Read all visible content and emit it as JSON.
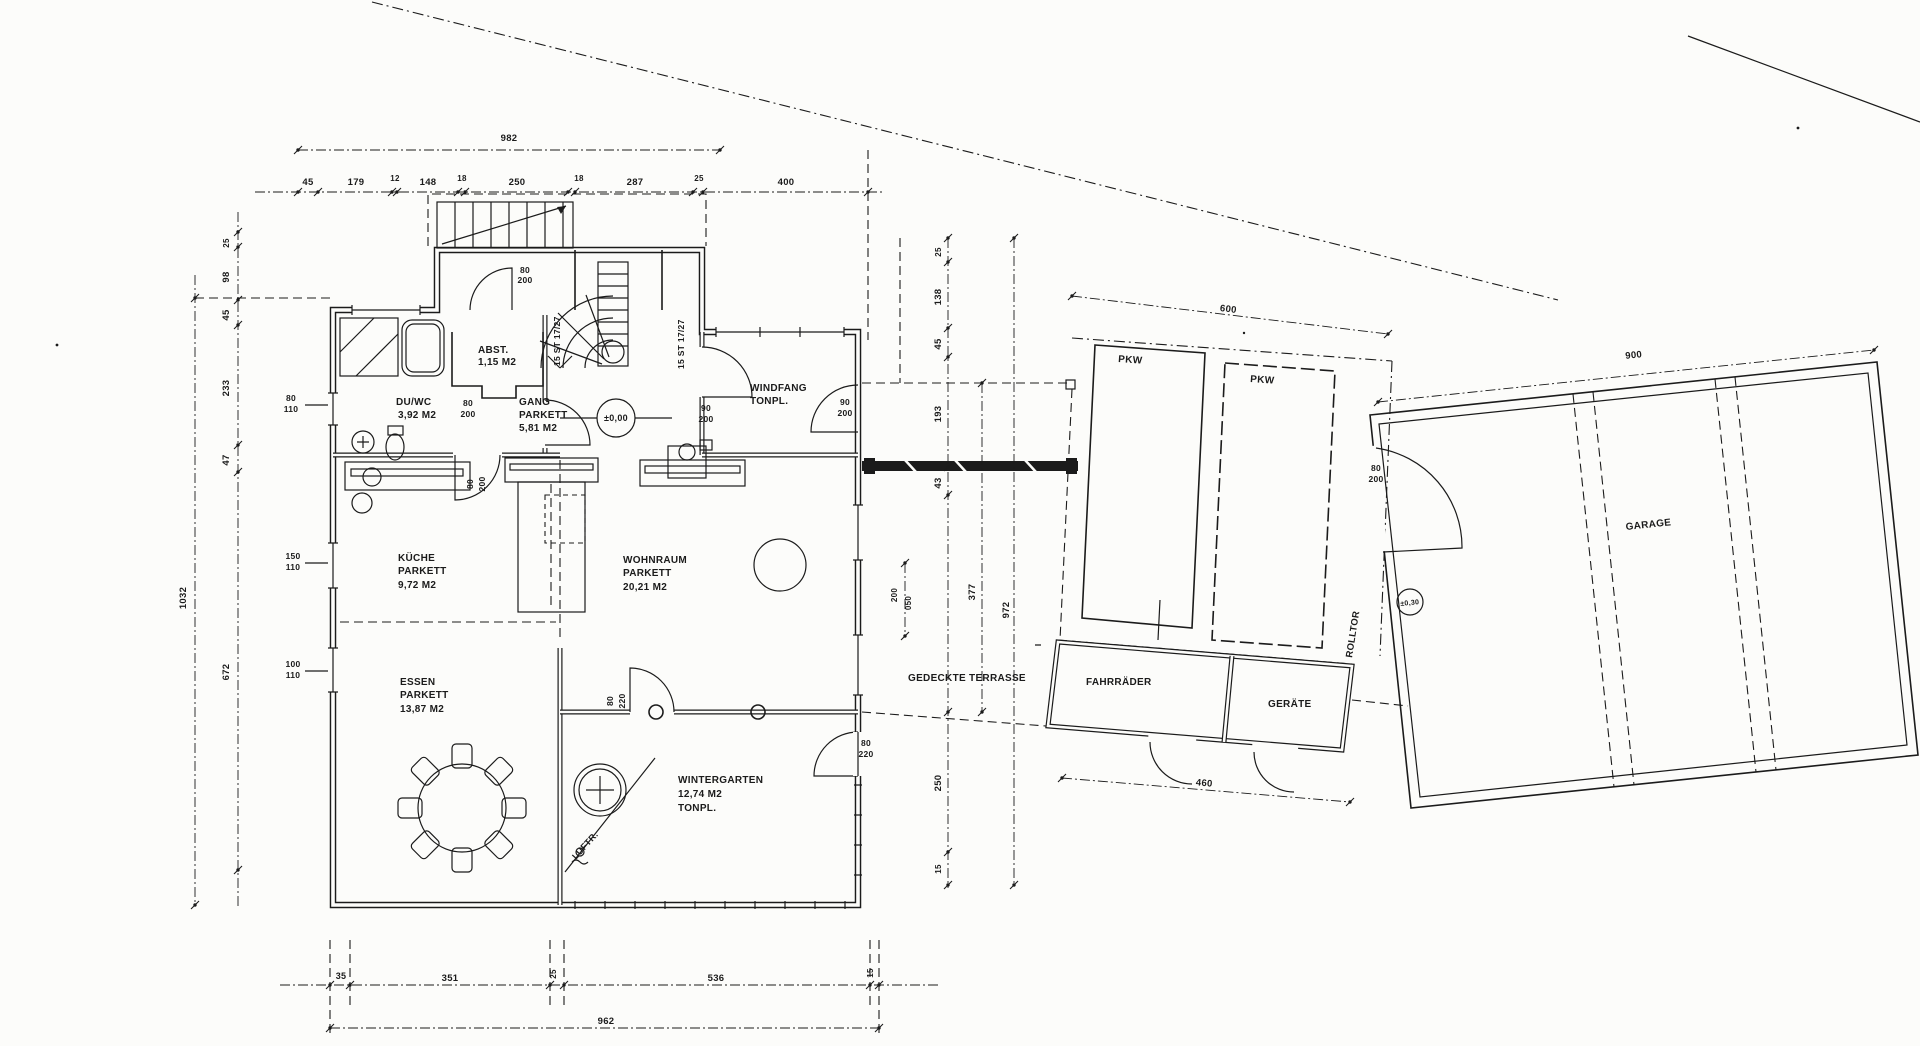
{
  "page": {
    "bg": "#fcfcfa",
    "ink": "#1b1b1b",
    "kind": "architectural floor plan (scanned blueprint)"
  },
  "rooms": [
    {
      "name": "ABST.",
      "area": "1,15 M2",
      "floor": ""
    },
    {
      "name": "DU/WC",
      "area": "3,92 M2",
      "floor": ""
    },
    {
      "name": "GANG",
      "area": "5,81 M2",
      "floor": "PARKETT"
    },
    {
      "name": "WINDFANG",
      "area": "",
      "floor": "TONPL."
    },
    {
      "name": "KÜCHE",
      "area": "9,72 M2",
      "floor": "PARKETT"
    },
    {
      "name": "WOHNRAUM",
      "area": "20,21 M2",
      "floor": "PARKETT"
    },
    {
      "name": "ESSEN",
      "area": "13,87 M2",
      "floor": "PARKETT"
    },
    {
      "name": "WINTERGARTEN",
      "area": "12,74 M2",
      "floor": "TONPL."
    },
    {
      "name": "GEDECKTE TERRASSE",
      "area": "",
      "floor": ""
    },
    {
      "name": "FAHRRÄDER",
      "area": "",
      "floor": ""
    },
    {
      "name": "GERÄTE",
      "area": "",
      "floor": ""
    },
    {
      "name": "PKW",
      "area": "",
      "floor": ""
    },
    {
      "name": "GARAGE",
      "area": "",
      "floor": ""
    }
  ],
  "labels": [
    {
      "n": "dim-top-total-982",
      "t": "982",
      "x": 509,
      "y": 141,
      "s": 9.5
    },
    {
      "n": "dim-top-45",
      "t": "45",
      "x": 308,
      "y": 185,
      "s": 9.5
    },
    {
      "n": "dim-top-179",
      "t": "179",
      "x": 356,
      "y": 185,
      "s": 9.5
    },
    {
      "n": "dim-top-12",
      "t": "12",
      "x": 395,
      "y": 181,
      "s": 8
    },
    {
      "n": "dim-top-148",
      "t": "148",
      "x": 428,
      "y": 185,
      "s": 9.5
    },
    {
      "n": "dim-top-18a",
      "t": "18",
      "x": 462,
      "y": 181,
      "s": 8
    },
    {
      "n": "dim-top-250",
      "t": "250",
      "x": 517,
      "y": 185,
      "s": 9.5
    },
    {
      "n": "dim-top-18b",
      "t": "18",
      "x": 579,
      "y": 181,
      "s": 8
    },
    {
      "n": "dim-top-287",
      "t": "287",
      "x": 635,
      "y": 185,
      "s": 9.5
    },
    {
      "n": "dim-top-25",
      "t": "25",
      "x": 699,
      "y": 181,
      "s": 8
    },
    {
      "n": "dim-top-400",
      "t": "400",
      "x": 786,
      "y": 185,
      "s": 9.5
    },
    {
      "n": "dim-left-25",
      "t": "25",
      "x": 229,
      "y": 243,
      "s": 8,
      "r": -90
    },
    {
      "n": "dim-left-98",
      "t": "98",
      "x": 229,
      "y": 277,
      "s": 9.5,
      "r": -90
    },
    {
      "n": "dim-left-45",
      "t": "45",
      "x": 229,
      "y": 315,
      "s": 9.5,
      "r": -90
    },
    {
      "n": "dim-left-233",
      "t": "233",
      "x": 229,
      "y": 388,
      "s": 9.5,
      "r": -90
    },
    {
      "n": "dim-left-47",
      "t": "47",
      "x": 229,
      "y": 460,
      "s": 9.5,
      "r": -90
    },
    {
      "n": "dim-left-672",
      "t": "672",
      "x": 229,
      "y": 672,
      "s": 9.5,
      "r": -90
    },
    {
      "n": "dim-left-total-1032",
      "t": "1032",
      "x": 186,
      "y": 598,
      "s": 9.5,
      "r": -90
    },
    {
      "n": "dim-right-25",
      "t": "25",
      "x": 941,
      "y": 252,
      "s": 8,
      "r": -90
    },
    {
      "n": "dim-right-138",
      "t": "138",
      "x": 941,
      "y": 297,
      "s": 9.5,
      "r": -90
    },
    {
      "n": "dim-right-45",
      "t": "45",
      "x": 941,
      "y": 344,
      "s": 9.5,
      "r": -90
    },
    {
      "n": "dim-right-193",
      "t": "193",
      "x": 941,
      "y": 414,
      "s": 9.5,
      "r": -90
    },
    {
      "n": "dim-right-43",
      "t": "43",
      "x": 941,
      "y": 483,
      "s": 9.5,
      "r": -90
    },
    {
      "n": "dim-right-250",
      "t": "250",
      "x": 941,
      "y": 783,
      "s": 9.5,
      "r": -90
    },
    {
      "n": "dim-right-15",
      "t": "15",
      "x": 941,
      "y": 869,
      "s": 8,
      "r": -90
    },
    {
      "n": "dim-right-377",
      "t": "377",
      "x": 975,
      "y": 592,
      "s": 9.5,
      "r": -90
    },
    {
      "n": "dim-right-total-972",
      "t": "972",
      "x": 1009,
      "y": 610,
      "s": 9.5,
      "r": -90
    },
    {
      "n": "dim-right-200",
      "t": "200",
      "x": 897,
      "y": 595,
      "s": 8,
      "r": -90
    },
    {
      "n": "dim-right-050",
      "t": "050",
      "x": 911,
      "y": 603,
      "s": 8,
      "r": -90
    },
    {
      "n": "dim-bottom-35",
      "t": "35",
      "x": 341,
      "y": 979,
      "s": 9
    },
    {
      "n": "dim-bottom-351",
      "t": "351",
      "x": 450,
      "y": 981,
      "s": 9.5
    },
    {
      "n": "dim-bottom-25",
      "t": "25",
      "x": 556,
      "y": 974,
      "s": 8,
      "r": -90
    },
    {
      "n": "dim-bottom-536",
      "t": "536",
      "x": 716,
      "y": 981,
      "s": 9.5
    },
    {
      "n": "dim-bottom-15",
      "t": "15",
      "x": 873,
      "y": 973,
      "s": 8,
      "r": -90
    },
    {
      "n": "dim-bottom-total-962",
      "t": "962",
      "x": 606,
      "y": 1024,
      "s": 9.5
    },
    {
      "n": "dim-600",
      "t": "600",
      "x": 1228,
      "y": 312,
      "s": 9.5,
      "r": 7
    },
    {
      "n": "dim-900",
      "t": "900",
      "x": 1634,
      "y": 358,
      "s": 9.5,
      "r": -6
    },
    {
      "n": "dim-460",
      "t": "460",
      "x": 1204,
      "y": 786,
      "s": 9.5,
      "r": 5
    },
    {
      "n": "room-abst",
      "t": "ABST.",
      "x": 478,
      "y": 353,
      "s": 10,
      "a": "start"
    },
    {
      "n": "room-abst-area",
      "t": "1,15 M2",
      "x": 478,
      "y": 365,
      "s": 10,
      "a": "start"
    },
    {
      "n": "room-duwc",
      "t": "DU/WC",
      "x": 396,
      "y": 405,
      "s": 10,
      "a": "start"
    },
    {
      "n": "room-duwc-area",
      "t": "3,92 M2",
      "x": 398,
      "y": 418,
      "s": 10,
      "a": "start"
    },
    {
      "n": "room-gang",
      "t": "GANG",
      "x": 519,
      "y": 405,
      "s": 10,
      "a": "start"
    },
    {
      "n": "room-gang-floor",
      "t": "PARKETT",
      "x": 519,
      "y": 418,
      "s": 10,
      "a": "start"
    },
    {
      "n": "room-gang-area",
      "t": "5,81  M2",
      "x": 519,
      "y": 431,
      "s": 10,
      "a": "start"
    },
    {
      "n": "room-windfang",
      "t": "WINDFANG",
      "x": 750,
      "y": 391,
      "s": 10,
      "a": "start"
    },
    {
      "n": "room-windfang-floor",
      "t": "TONPL.",
      "x": 750,
      "y": 404,
      "s": 10,
      "a": "start"
    },
    {
      "n": "room-kueche",
      "t": "KÜCHE",
      "x": 398,
      "y": 561,
      "s": 10,
      "a": "start"
    },
    {
      "n": "room-kueche-floor",
      "t": "PARKETT",
      "x": 398,
      "y": 574,
      "s": 10,
      "a": "start"
    },
    {
      "n": "room-kueche-area",
      "t": "9,72  M2",
      "x": 398,
      "y": 588,
      "s": 10,
      "a": "start"
    },
    {
      "n": "room-wohnraum",
      "t": "WOHNRAUM",
      "x": 623,
      "y": 563,
      "s": 10,
      "a": "start"
    },
    {
      "n": "room-wohnraum-floor",
      "t": "PARKETT",
      "x": 623,
      "y": 576,
      "s": 10,
      "a": "start"
    },
    {
      "n": "room-wohnraum-area",
      "t": "20,21 M2",
      "x": 623,
      "y": 590,
      "s": 10,
      "a": "start"
    },
    {
      "n": "room-essen",
      "t": "ESSEN",
      "x": 400,
      "y": 685,
      "s": 10,
      "a": "start"
    },
    {
      "n": "room-essen-floor",
      "t": "PARKETT",
      "x": 400,
      "y": 698,
      "s": 10,
      "a": "start"
    },
    {
      "n": "room-essen-area",
      "t": "13,87  M2",
      "x": 400,
      "y": 712,
      "s": 10,
      "a": "start"
    },
    {
      "n": "room-wintergarten",
      "t": "WINTERGARTEN",
      "x": 678,
      "y": 783,
      "s": 10,
      "a": "start"
    },
    {
      "n": "room-wintergarten-area",
      "t": "12,74  M2",
      "x": 678,
      "y": 797,
      "s": 10,
      "a": "start"
    },
    {
      "n": "room-wintergarten-floor",
      "t": "TONPL.",
      "x": 678,
      "y": 811,
      "s": 10,
      "a": "start"
    },
    {
      "n": "room-terrasse",
      "t": "GEDECKTE TERRASSE",
      "x": 908,
      "y": 681,
      "s": 10,
      "a": "start"
    },
    {
      "n": "room-fahrraeder",
      "t": "FAHRRÄDER",
      "x": 1086,
      "y": 685,
      "s": 10,
      "a": "start"
    },
    {
      "n": "room-geraete",
      "t": "GERÄTE",
      "x": 1268,
      "y": 707,
      "s": 10,
      "a": "start"
    },
    {
      "n": "room-pkw-1",
      "t": "PKW",
      "x": 1118,
      "y": 362,
      "s": 10,
      "a": "start",
      "r": 4
    },
    {
      "n": "room-pkw-2",
      "t": "PKW",
      "x": 1250,
      "y": 382,
      "s": 10,
      "a": "start",
      "r": 4
    },
    {
      "n": "room-garage",
      "t": "GARAGE",
      "x": 1626,
      "y": 530,
      "s": 10,
      "a": "start",
      "r": -6
    },
    {
      "n": "label-rolltor",
      "t": "ROLLTOR",
      "x": 1352,
      "y": 658,
      "s": 9.5,
      "a": "start",
      "r": -81
    },
    {
      "n": "door-annex-80",
      "t": "80",
      "x": 525,
      "y": 273,
      "s": 8.5
    },
    {
      "n": "door-annex-200",
      "t": "200",
      "x": 525,
      "y": 283,
      "s": 8.5
    },
    {
      "n": "win-duwc-80",
      "t": "80",
      "x": 291,
      "y": 401,
      "s": 8.5
    },
    {
      "n": "win-duwc-110",
      "t": "110",
      "x": 291,
      "y": 412,
      "s": 8.5
    },
    {
      "n": "door-duwc-80",
      "t": "80",
      "x": 468,
      "y": 406,
      "s": 8.5
    },
    {
      "n": "door-duwc-200",
      "t": "200",
      "x": 468,
      "y": 417,
      "s": 8.5
    },
    {
      "n": "door-gang-windfang-90",
      "t": "90",
      "x": 706,
      "y": 411,
      "s": 8.5
    },
    {
      "n": "door-gang-windfang-200",
      "t": "200",
      "x": 706,
      "y": 422,
      "s": 8.5
    },
    {
      "n": "door-windfang-ost-90",
      "t": "90",
      "x": 845,
      "y": 405,
      "s": 8.5
    },
    {
      "n": "door-windfang-ost-200",
      "t": "200",
      "x": 845,
      "y": 416,
      "s": 8.5
    },
    {
      "n": "door-kueche-80",
      "t": "80",
      "x": 473,
      "y": 484,
      "s": 8.5,
      "r": -90
    },
    {
      "n": "door-kueche-200",
      "t": "200",
      "x": 485,
      "y": 484,
      "s": 8.5,
      "r": -90
    },
    {
      "n": "door-wintergarten-80",
      "t": "80",
      "x": 613,
      "y": 701,
      "s": 8.5,
      "r": -90
    },
    {
      "n": "door-wintergarten-220",
      "t": "220",
      "x": 625,
      "y": 701,
      "s": 8.5,
      "r": -90
    },
    {
      "n": "door-terrasse-80",
      "t": "80",
      "x": 866,
      "y": 746,
      "s": 8.5
    },
    {
      "n": "door-terrasse-220",
      "t": "220",
      "x": 866,
      "y": 757,
      "s": 8.5
    },
    {
      "n": "win-essen-150",
      "t": "150",
      "x": 293,
      "y": 559,
      "s": 8.5
    },
    {
      "n": "win-essen-110a",
      "t": "110",
      "x": 293,
      "y": 570,
      "s": 8.5
    },
    {
      "n": "win-essen-100",
      "t": "100",
      "x": 293,
      "y": 667,
      "s": 8.5
    },
    {
      "n": "win-essen-110b",
      "t": "110",
      "x": 293,
      "y": 678,
      "s": 8.5
    },
    {
      "n": "door-garage-80",
      "t": "80",
      "x": 1376,
      "y": 471,
      "s": 8.5
    },
    {
      "n": "door-garage-200",
      "t": "200",
      "x": 1376,
      "y": 482,
      "s": 8.5
    },
    {
      "n": "stair-left",
      "t": "15 ST 17/27",
      "x": 560,
      "y": 366,
      "s": 8.5,
      "r": -90,
      "a": "start"
    },
    {
      "n": "stair-right",
      "t": "15 ST 17/27",
      "x": 684,
      "y": 369,
      "s": 8.5,
      "r": -90,
      "a": "start"
    },
    {
      "n": "label-luftr",
      "t": "LUFTR.",
      "x": 576,
      "y": 860,
      "s": 9,
      "a": "start",
      "r": -48
    },
    {
      "n": "level-zero",
      "t": "±0,00",
      "x": 616,
      "y": 421,
      "s": 9
    },
    {
      "n": "level-garage",
      "t": "±0,30",
      "x": 1410,
      "y": 605,
      "s": 7,
      "r": -6
    }
  ],
  "dims": [
    {
      "x1": 298,
      "y1": 150,
      "x2": 720,
      "y2": 150,
      "ticks": [
        [
          298,
          150
        ],
        [
          720,
          150
        ]
      ]
    },
    {
      "x1": 255,
      "y1": 192,
      "x2": 884,
      "y2": 192,
      "ticks": [
        [
          298,
          192
        ],
        [
          318,
          192
        ],
        [
          392,
          192
        ],
        [
          397,
          192
        ],
        [
          458,
          192
        ],
        [
          465,
          192
        ],
        [
          568,
          192
        ],
        [
          575,
          192
        ],
        [
          693,
          192
        ],
        [
          703,
          192
        ],
        [
          868,
          192
        ]
      ]
    },
    {
      "x1": 195,
      "y1": 275,
      "x2": 195,
      "y2": 905,
      "ticks": [
        [
          195,
          298
        ],
        [
          195,
          905
        ]
      ]
    },
    {
      "x1": 238,
      "y1": 212,
      "x2": 238,
      "y2": 908,
      "ticks": [
        [
          238,
          232
        ],
        [
          238,
          247
        ],
        [
          238,
          300
        ],
        [
          238,
          325
        ],
        [
          238,
          445
        ],
        [
          238,
          472
        ],
        [
          238,
          870
        ]
      ]
    },
    {
      "x1": 948,
      "y1": 238,
      "x2": 948,
      "y2": 888,
      "ticks": [
        [
          948,
          238
        ],
        [
          948,
          262
        ],
        [
          948,
          328
        ],
        [
          948,
          357
        ],
        [
          948,
          467
        ],
        [
          948,
          495
        ],
        [
          948,
          712
        ],
        [
          948,
          852
        ],
        [
          948,
          885
        ]
      ]
    },
    {
      "x1": 982,
      "y1": 383,
      "x2": 982,
      "y2": 712,
      "ticks": [
        [
          982,
          383
        ],
        [
          982,
          712
        ]
      ]
    },
    {
      "x1": 1014,
      "y1": 238,
      "x2": 1014,
      "y2": 885,
      "ticks": [
        [
          1014,
          238
        ],
        [
          1014,
          885
        ]
      ]
    },
    {
      "x1": 905,
      "y1": 563,
      "x2": 905,
      "y2": 636,
      "ticks": [
        [
          905,
          563
        ],
        [
          905,
          636
        ]
      ]
    },
    {
      "x1": 280,
      "y1": 985,
      "x2": 940,
      "y2": 985,
      "ticks": [
        [
          330,
          985
        ],
        [
          350,
          985
        ],
        [
          550,
          985
        ],
        [
          564,
          985
        ],
        [
          870,
          985
        ],
        [
          879,
          985
        ]
      ]
    },
    {
      "x1": 330,
      "y1": 1028,
      "x2": 879,
      "y2": 1028,
      "ticks": [
        [
          330,
          1028
        ],
        [
          879,
          1028
        ]
      ]
    },
    {
      "x1": 1072,
      "y1": 296,
      "x2": 1388,
      "y2": 334,
      "ticks": [
        [
          1072,
          296
        ],
        [
          1388,
          334
        ]
      ]
    },
    {
      "x1": 1378,
      "y1": 402,
      "x2": 1874,
      "y2": 350,
      "ticks": [
        [
          1378,
          402
        ],
        [
          1874,
          350
        ]
      ]
    },
    {
      "x1": 1062,
      "y1": 778,
      "x2": 1350,
      "y2": 802,
      "ticks": [
        [
          1062,
          778
        ],
        [
          1350,
          802
        ]
      ]
    }
  ]
}
